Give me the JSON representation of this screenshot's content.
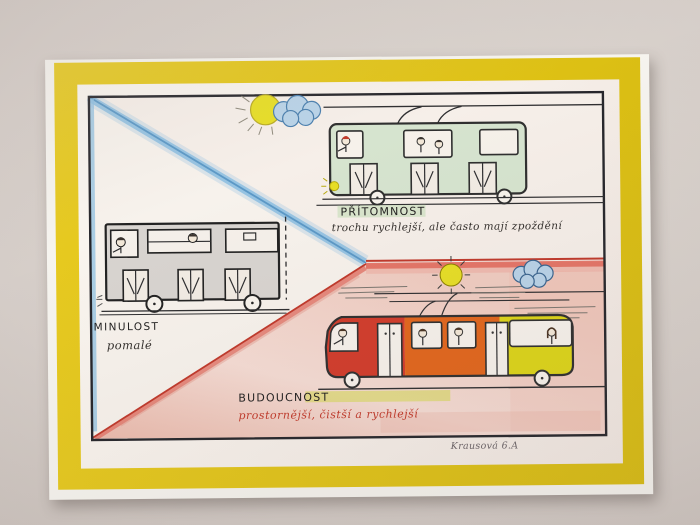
{
  "artwork": {
    "past": {
      "title": "MINULOST",
      "caption": "pomalé"
    },
    "present": {
      "title": "PŘÍTOMNOST",
      "caption": "trochu rychlejší, ale často mají zpoždění"
    },
    "future": {
      "title": "BUDOUCNOST",
      "caption": "prostornější, čistší a rychlejší"
    },
    "signature": "Krausová 6.A"
  },
  "colors": {
    "paper_yellow": "#e0c316",
    "edge_blue": "#8fc0e2",
    "edge_red": "#d8493c",
    "future_pink": "#f1cfc5",
    "bus_green": "#d6e4cf",
    "bus_past_grey": "#d8d4d0",
    "tram_red": "#d23c2b",
    "tram_orange": "#e2661c",
    "tram_yellow": "#ddd518",
    "sun_yellow": "#e7de25",
    "cloud_blue": "#b9d3e8",
    "highlight_green": "#cfe2c2",
    "highlight_yellow_green": "#d6da4e"
  }
}
